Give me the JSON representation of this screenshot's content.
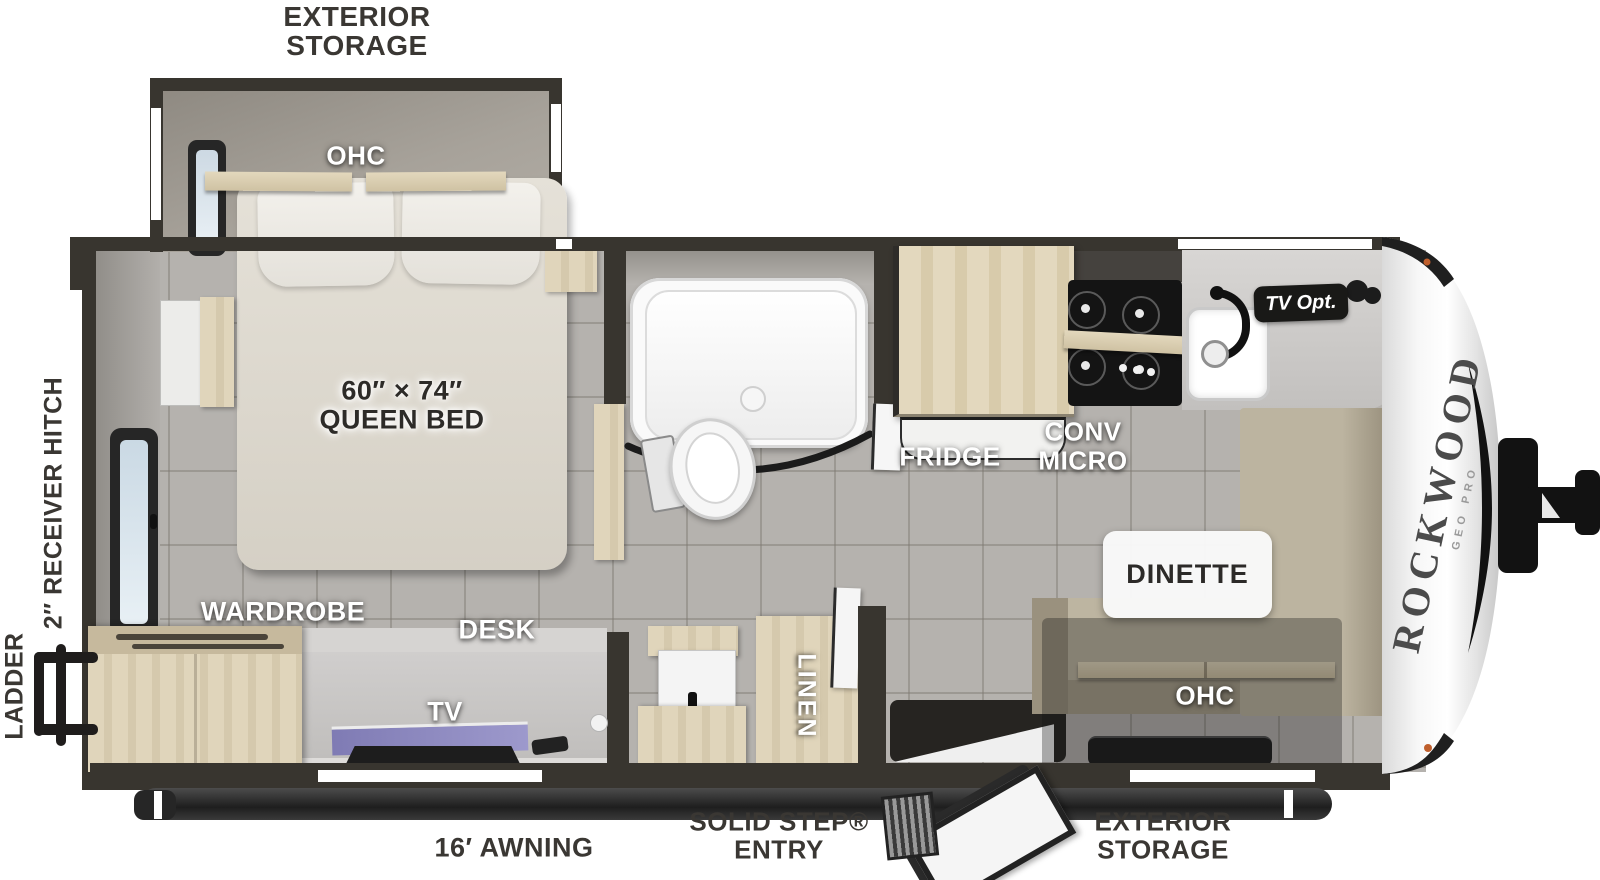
{
  "floorplan": {
    "title": "Rockwood Geo Pro travel trailer floorplan",
    "brand": {
      "name": "ROCKWOOD",
      "sub": "GEO PRO"
    },
    "labels": {
      "exterior_storage_top_1": "EXTERIOR",
      "exterior_storage_top_2": "STORAGE",
      "ohc_bedroom": "OHC",
      "bed_size": "60″ × 74″",
      "bed_name": "QUEEN BED",
      "receiver_hitch": "2″ RECEIVER HITCH",
      "ladder": "LADDER",
      "wardrobe": "WARDROBE",
      "desk": "DESK",
      "tv": "TV",
      "awning": "16′ AWNING",
      "linen": "LINEN",
      "entry_1": "SOLID STEP®",
      "entry_2": "ENTRY",
      "exterior_storage_bottom_1": "EXTERIOR",
      "exterior_storage_bottom_2": "STORAGE",
      "ohc_dinette": "OHC",
      "dinette": "DINETTE",
      "fridge": "FRIDGE",
      "conv_micro_1": "CONV",
      "conv_micro_2": "MICRO",
      "tv_opt": "TV Opt."
    },
    "colors": {
      "wall": "#38352f",
      "floor": "#b5b2ae",
      "wood": "#dbd0b5",
      "cushion": "#b9b19d",
      "screen_accent": "#8b87c0",
      "label_dark": "#3a3733",
      "label_white": "#ffffff",
      "marker_light": "#bf5f2d"
    }
  }
}
